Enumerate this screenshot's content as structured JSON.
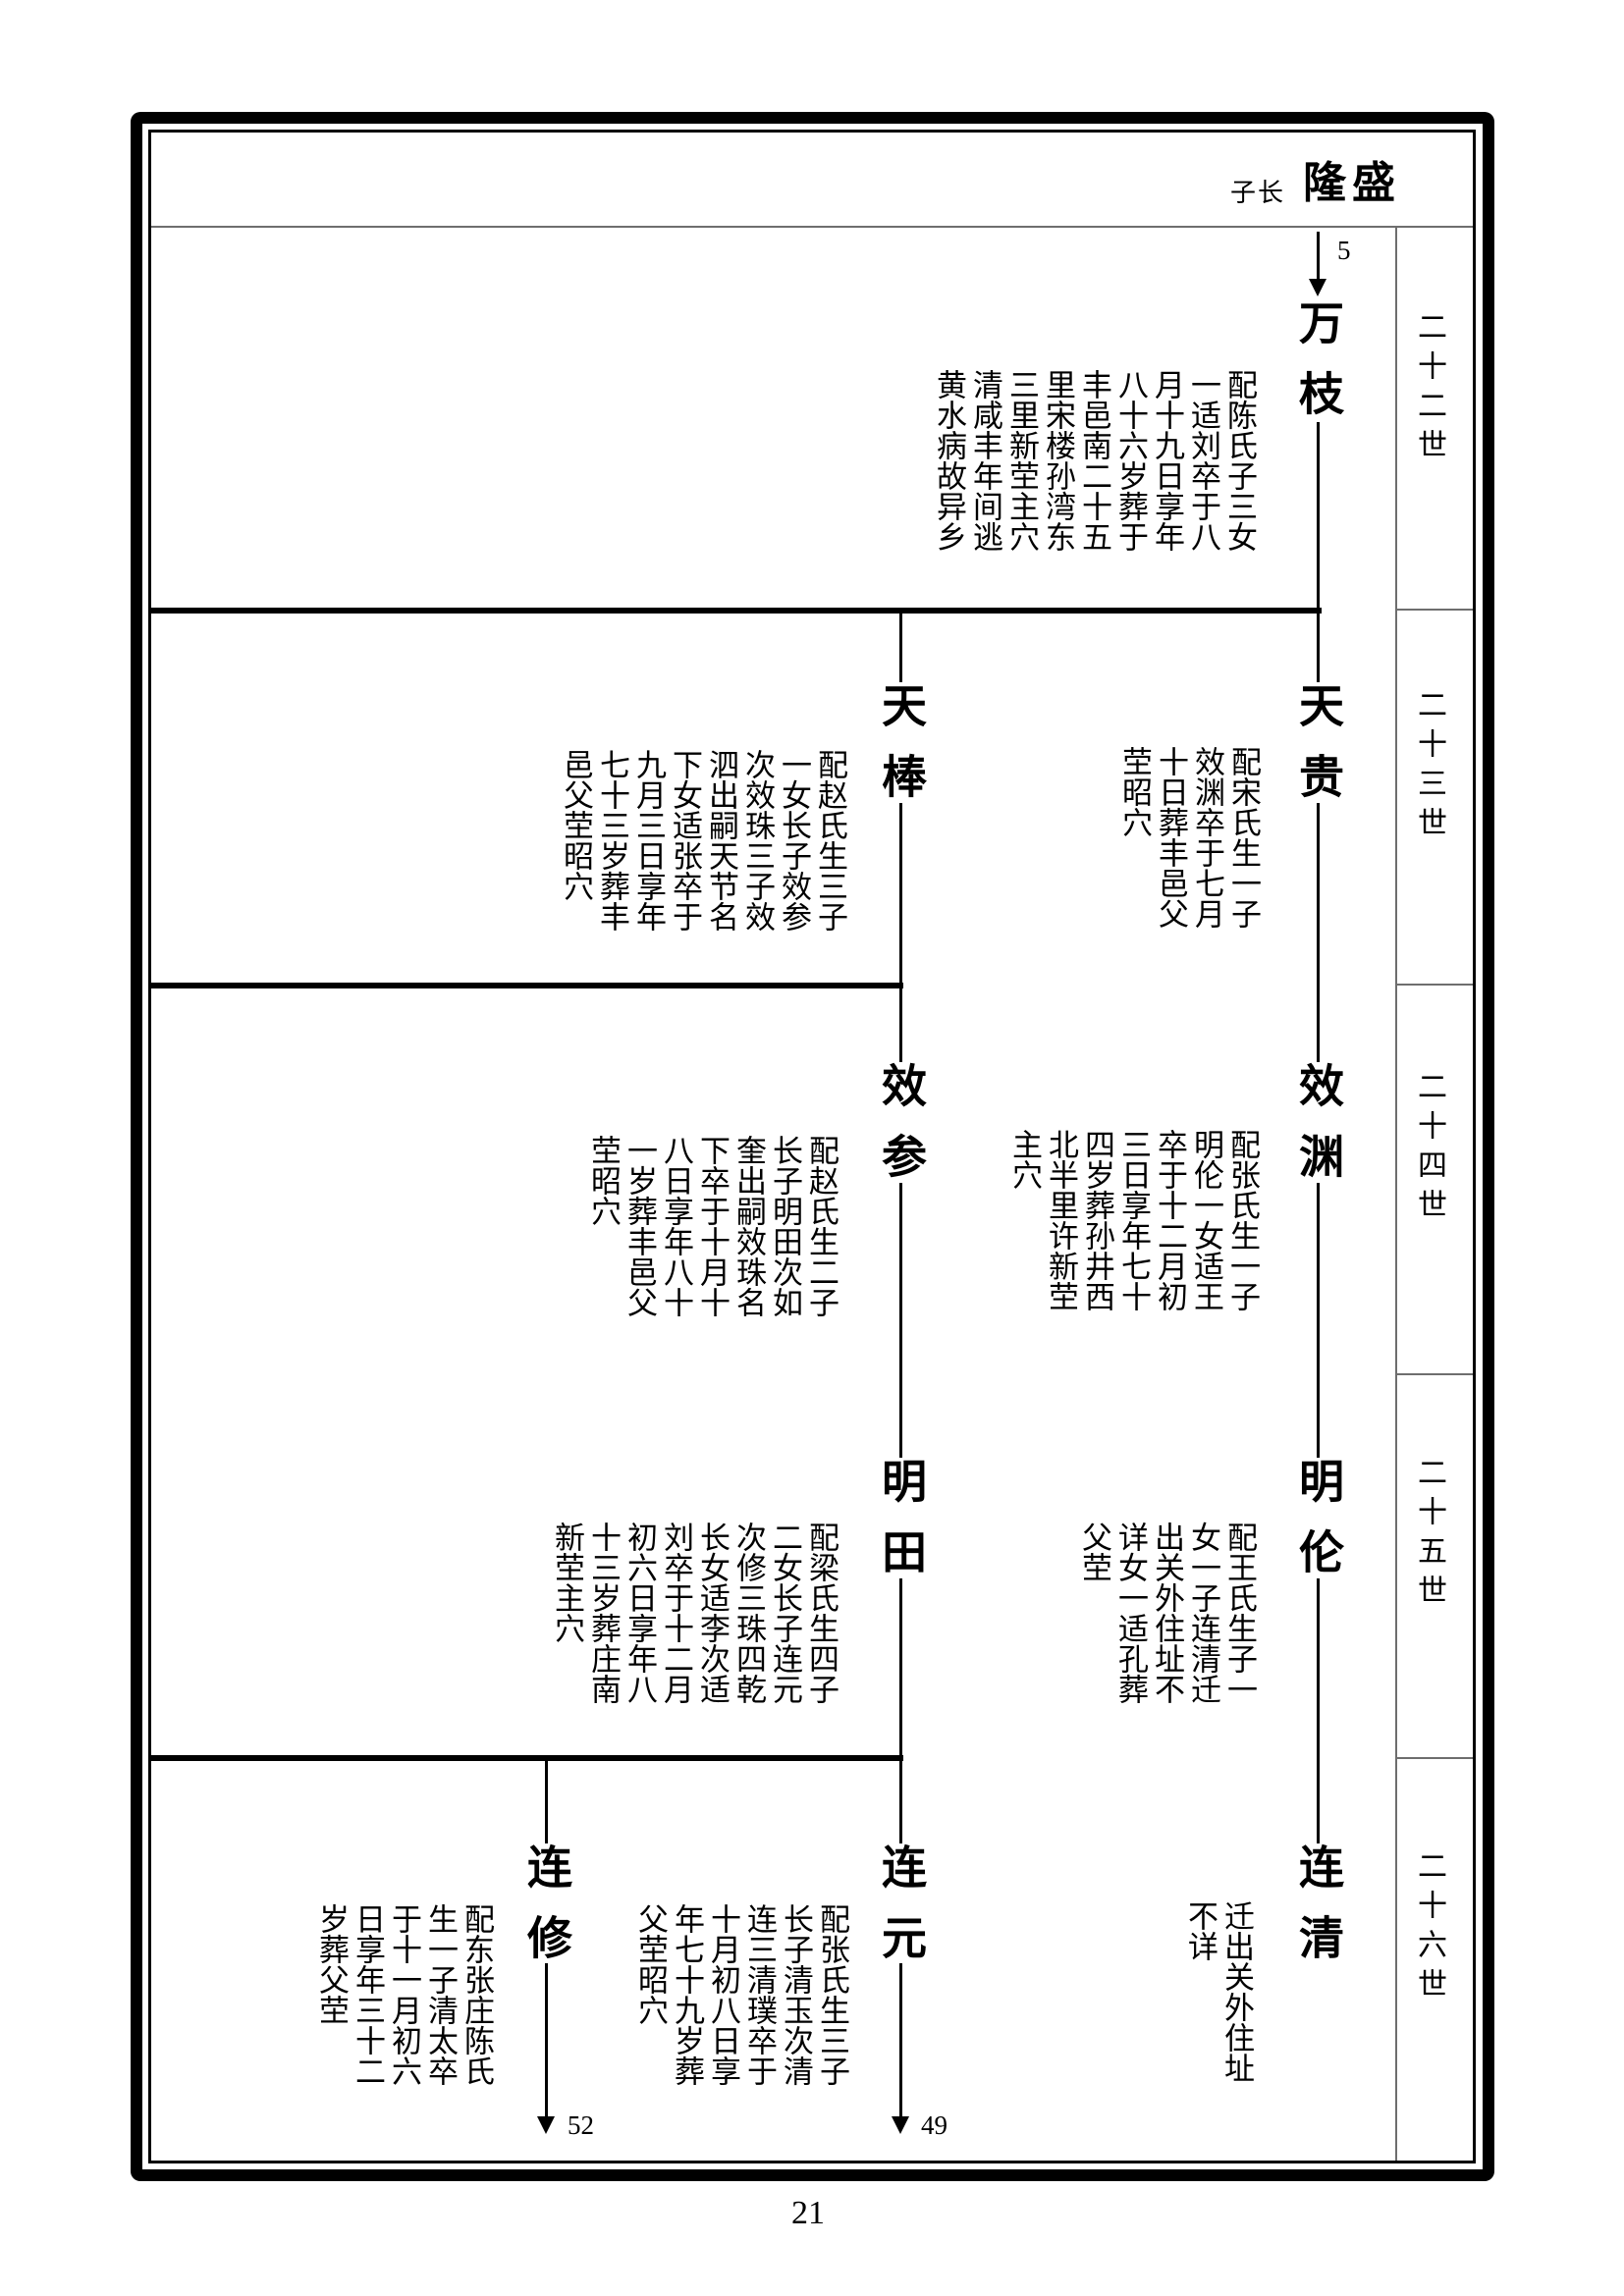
{
  "colors": {
    "ink": "#000000",
    "line_gray": "#6e6e6e",
    "paper": "#ffffff"
  },
  "header": {
    "prefix": "子长",
    "title": "隆盛"
  },
  "sidebar": {
    "generations": [
      "二十二世",
      "二十三世",
      "二十四世",
      "二十五世",
      "二十六世"
    ]
  },
  "arrows": {
    "top": "5",
    "bottom_left": "52",
    "bottom_right": "49"
  },
  "footer": {
    "page_number": "21"
  },
  "tree": {
    "persons": [
      {
        "id": "wanzhi",
        "name": "万枝",
        "desc": "配陈氏子三女一适刘卒于八月十九日享年八十六岁葬于丰邑南二十五里宋楼孙湾东三里新茔主穴清咸丰年间逃黄水病故异乡"
      },
      {
        "id": "tiangui",
        "name": "天贵",
        "desc": "配宋氏生一子效渊卒于七月十日葬丰邑父茔昭穴"
      },
      {
        "id": "tianbang",
        "name": "天棒",
        "desc": "配赵氏生三子一女长子效参次效珠三子效泗出嗣天节名下女适张卒于九月三日享年七十三岁葬丰邑父茔昭穴"
      },
      {
        "id": "xiaoyuan",
        "name": "效渊",
        "desc": "配张氏生一子明伦一女适王卒于十二月初三日享年七十四岁葬孙井西北半里许新茔主穴"
      },
      {
        "id": "xiaocan",
        "name": "效参",
        "desc": "配赵氏生二子长子明田次如奎出嗣效珠名下卒于十月十八日享年八十一岁葬丰邑父茔昭穴"
      },
      {
        "id": "minglun",
        "name": "明伦",
        "desc": "配王氏生子一女一子连清迁出关外住址不详女一适孔葬父茔"
      },
      {
        "id": "mingtian",
        "name": "明田",
        "desc": "配梁氏生四子二女长子连元次修三珠四乾长女适李次适刘卒于十二月初六日享年八十三岁葬庄南新茔主穴"
      },
      {
        "id": "lianqing",
        "name": "连清",
        "desc": "迁出关外住址不详"
      },
      {
        "id": "lianyuan",
        "name": "连元",
        "desc": "配张氏生三子长子清玉次清连三清璞卒于十月初八日享年七十九岁葬父茔昭穴"
      },
      {
        "id": "lianxiu",
        "name": "连修",
        "desc": "配东张庄陈氏生一子清太卒于十一月初六日享年三十二岁葬父茔"
      }
    ]
  }
}
